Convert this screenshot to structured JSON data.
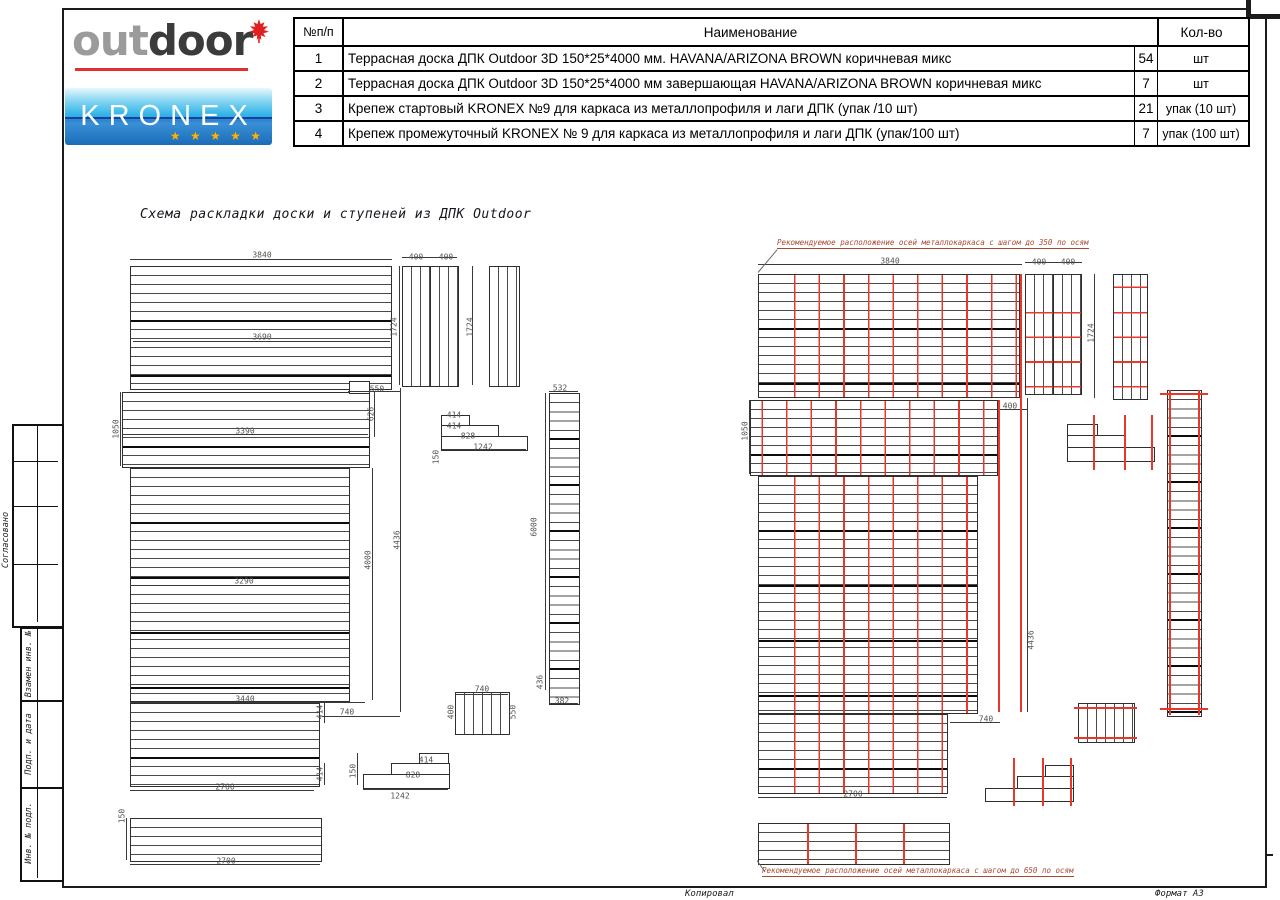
{
  "logos": {
    "outdoor_part1": "out",
    "outdoor_part2": "door",
    "kronex_text": "KRONEX",
    "kronex_stars": "★ ★ ★ ★ ★",
    "accent_red": "#e03030",
    "kronex_blue": "#2a83cf"
  },
  "spec_table": {
    "headers": {
      "num": "№п/п",
      "name": "Наименование",
      "qty_unit": "Кол-во"
    },
    "rows": [
      {
        "num": "1",
        "name": "Террасная доска ДПК Outdoor 3D 150*25*4000 мм. HAVANA/ARIZONA BROWN коричневая микс",
        "qty": "54",
        "unit": "шт"
      },
      {
        "num": "2",
        "name": "Террасная доска ДПК Outdoor 3D 150*25*4000 мм завершающая HAVANA/ARIZONA BROWN коричневая микс",
        "qty": "7",
        "unit": "шт"
      },
      {
        "num": "3",
        "name": "Крепеж стартовый KRONEX №9 для каркаса из металлопрофиля и лаги ДПК (упак /10 шт)",
        "qty": "21",
        "unit": "упак (10 шт)"
      },
      {
        "num": "4",
        "name": "Крепеж промежуточный KRONEX № 9 для каркаса из металлопрофиля и лаги ДПК (упак/100 шт)",
        "qty": "7",
        "unit": "упак (100 шт)"
      }
    ]
  },
  "drawing_title": "Схема раскладки доски и ступеней из ДПК Outdoor",
  "annotations": {
    "axes_350": "Рекомендуемое расположение осей металлокаркаса с шагом до 350 по осям",
    "axes_650": "Рекомендуемое расположение осей металлокаркаса с шагом до 650 по осям",
    "axis_color": "#e8382c"
  },
  "margin": {
    "labels": [
      "Согласовано",
      "Взамен инв. №",
      "Подп. и дата",
      "Инв. № подл."
    ]
  },
  "footer": {
    "copied": "Копировал",
    "format": "Формат А3"
  },
  "dim_labels": [
    {
      "t": "3840",
      "x": 262,
      "y": 255
    },
    {
      "t": "400",
      "x": 416,
      "y": 257
    },
    {
      "t": "400",
      "x": 446,
      "y": 257
    },
    {
      "t": "3690",
      "x": 262,
      "y": 337
    },
    {
      "t": "1724",
      "x": 394,
      "y": 327,
      "r": 1
    },
    {
      "t": "1724",
      "x": 470,
      "y": 327,
      "r": 1
    },
    {
      "t": "550",
      "x": 377,
      "y": 389
    },
    {
      "t": "626",
      "x": 371,
      "y": 414,
      "r": 1
    },
    {
      "t": "1050",
      "x": 116,
      "y": 429,
      "r": 1
    },
    {
      "t": "3390",
      "x": 245,
      "y": 431
    },
    {
      "t": "414",
      "x": 454,
      "y": 415
    },
    {
      "t": "414",
      "x": 454,
      "y": 426
    },
    {
      "t": "828",
      "x": 468,
      "y": 436
    },
    {
      "t": "1242",
      "x": 483,
      "y": 447
    },
    {
      "t": "150",
      "x": 436,
      "y": 457,
      "r": 1
    },
    {
      "t": "532",
      "x": 560,
      "y": 388
    },
    {
      "t": "6000",
      "x": 534,
      "y": 527,
      "r": 1
    },
    {
      "t": "4436",
      "x": 397,
      "y": 540,
      "r": 1
    },
    {
      "t": "4000",
      "x": 368,
      "y": 560,
      "r": 1
    },
    {
      "t": "3290",
      "x": 244,
      "y": 581
    },
    {
      "t": "3440",
      "x": 245,
      "y": 699
    },
    {
      "t": "740",
      "x": 347,
      "y": 712
    },
    {
      "t": "414",
      "x": 320,
      "y": 712,
      "r": 1
    },
    {
      "t": "414",
      "x": 320,
      "y": 774,
      "r": 1
    },
    {
      "t": "2700",
      "x": 225,
      "y": 787
    },
    {
      "t": "150",
      "x": 122,
      "y": 816,
      "r": 1
    },
    {
      "t": "2700",
      "x": 226,
      "y": 861
    },
    {
      "t": "436",
      "x": 540,
      "y": 682,
      "r": 1
    },
    {
      "t": "382",
      "x": 562,
      "y": 701
    },
    {
      "t": "740",
      "x": 482,
      "y": 689
    },
    {
      "t": "400",
      "x": 451,
      "y": 712,
      "r": 1
    },
    {
      "t": "550",
      "x": 513,
      "y": 712,
      "r": 1
    },
    {
      "t": "414",
      "x": 426,
      "y": 760
    },
    {
      "t": "828",
      "x": 413,
      "y": 775
    },
    {
      "t": "1242",
      "x": 400,
      "y": 796
    },
    {
      "t": "150",
      "x": 353,
      "y": 771,
      "r": 1
    },
    {
      "t": "3840",
      "x": 890,
      "y": 261
    },
    {
      "t": "400",
      "x": 1039,
      "y": 262
    },
    {
      "t": "400",
      "x": 1068,
      "y": 262
    },
    {
      "t": "1724",
      "x": 1091,
      "y": 333,
      "r": 1
    },
    {
      "t": "400",
      "x": 1010,
      "y": 406
    },
    {
      "t": "1050",
      "x": 745,
      "y": 431,
      "r": 1
    },
    {
      "t": "4436",
      "x": 1031,
      "y": 640,
      "r": 1
    },
    {
      "t": "740",
      "x": 986,
      "y": 719
    },
    {
      "t": "2700",
      "x": 853,
      "y": 794
    }
  ]
}
